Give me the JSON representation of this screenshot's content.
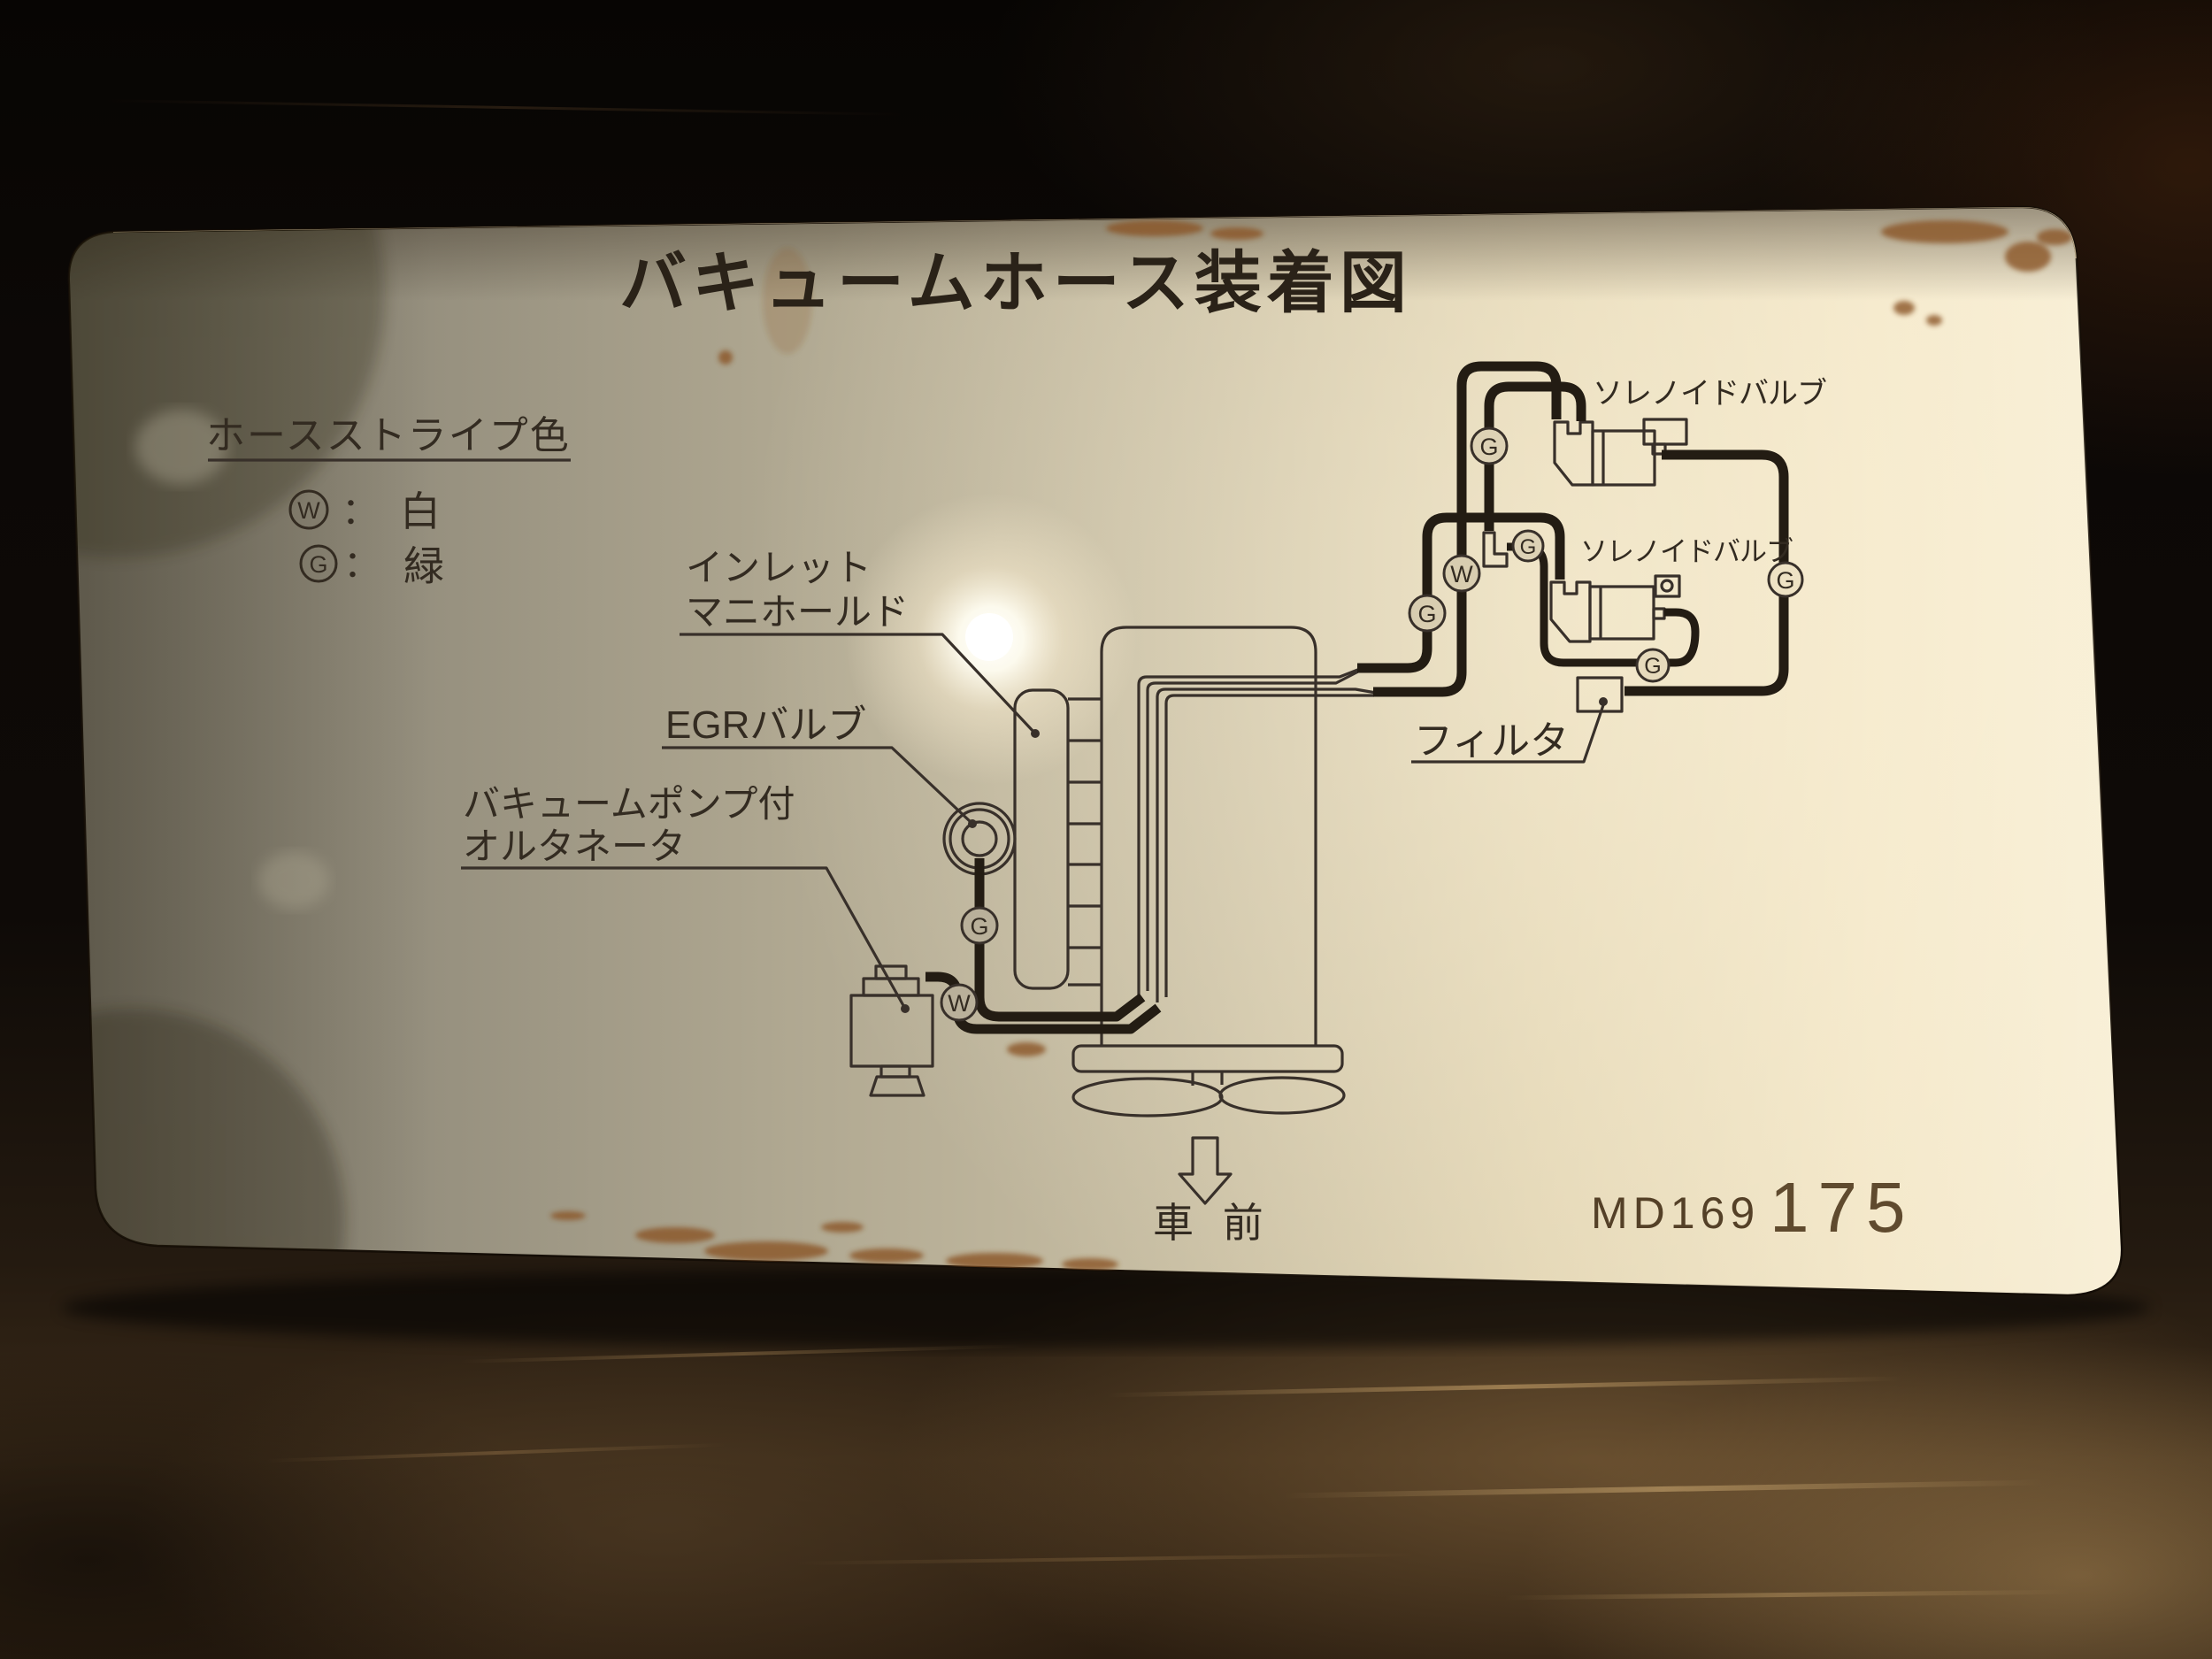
{
  "photo": {
    "plate_title": "バキュームホース装着図",
    "legend": {
      "title": "ホースストライプ色",
      "entries": [
        {
          "symbol": "W",
          "separator": "：",
          "color_name": "白"
        },
        {
          "symbol": "G",
          "separator": "：",
          "color_name": "緑"
        }
      ]
    },
    "labels": {
      "inlet_manifold_line1": "インレット",
      "inlet_manifold_line2": "マニホールド",
      "egr_valve": "EGRバルブ",
      "alternator_line1": "バキュームポンプ付",
      "alternator_line2": "オルタネータ",
      "solenoid_valve_upper": "ソレノイドバルブ",
      "solenoid_valve_lower": "ソレノイドバルブ",
      "filter": "フィルタ",
      "vehicle_front": "車 前"
    },
    "markers": {
      "white": "W",
      "green": "G"
    },
    "part_number": {
      "prefix": "MD169",
      "suffix": "175"
    }
  }
}
